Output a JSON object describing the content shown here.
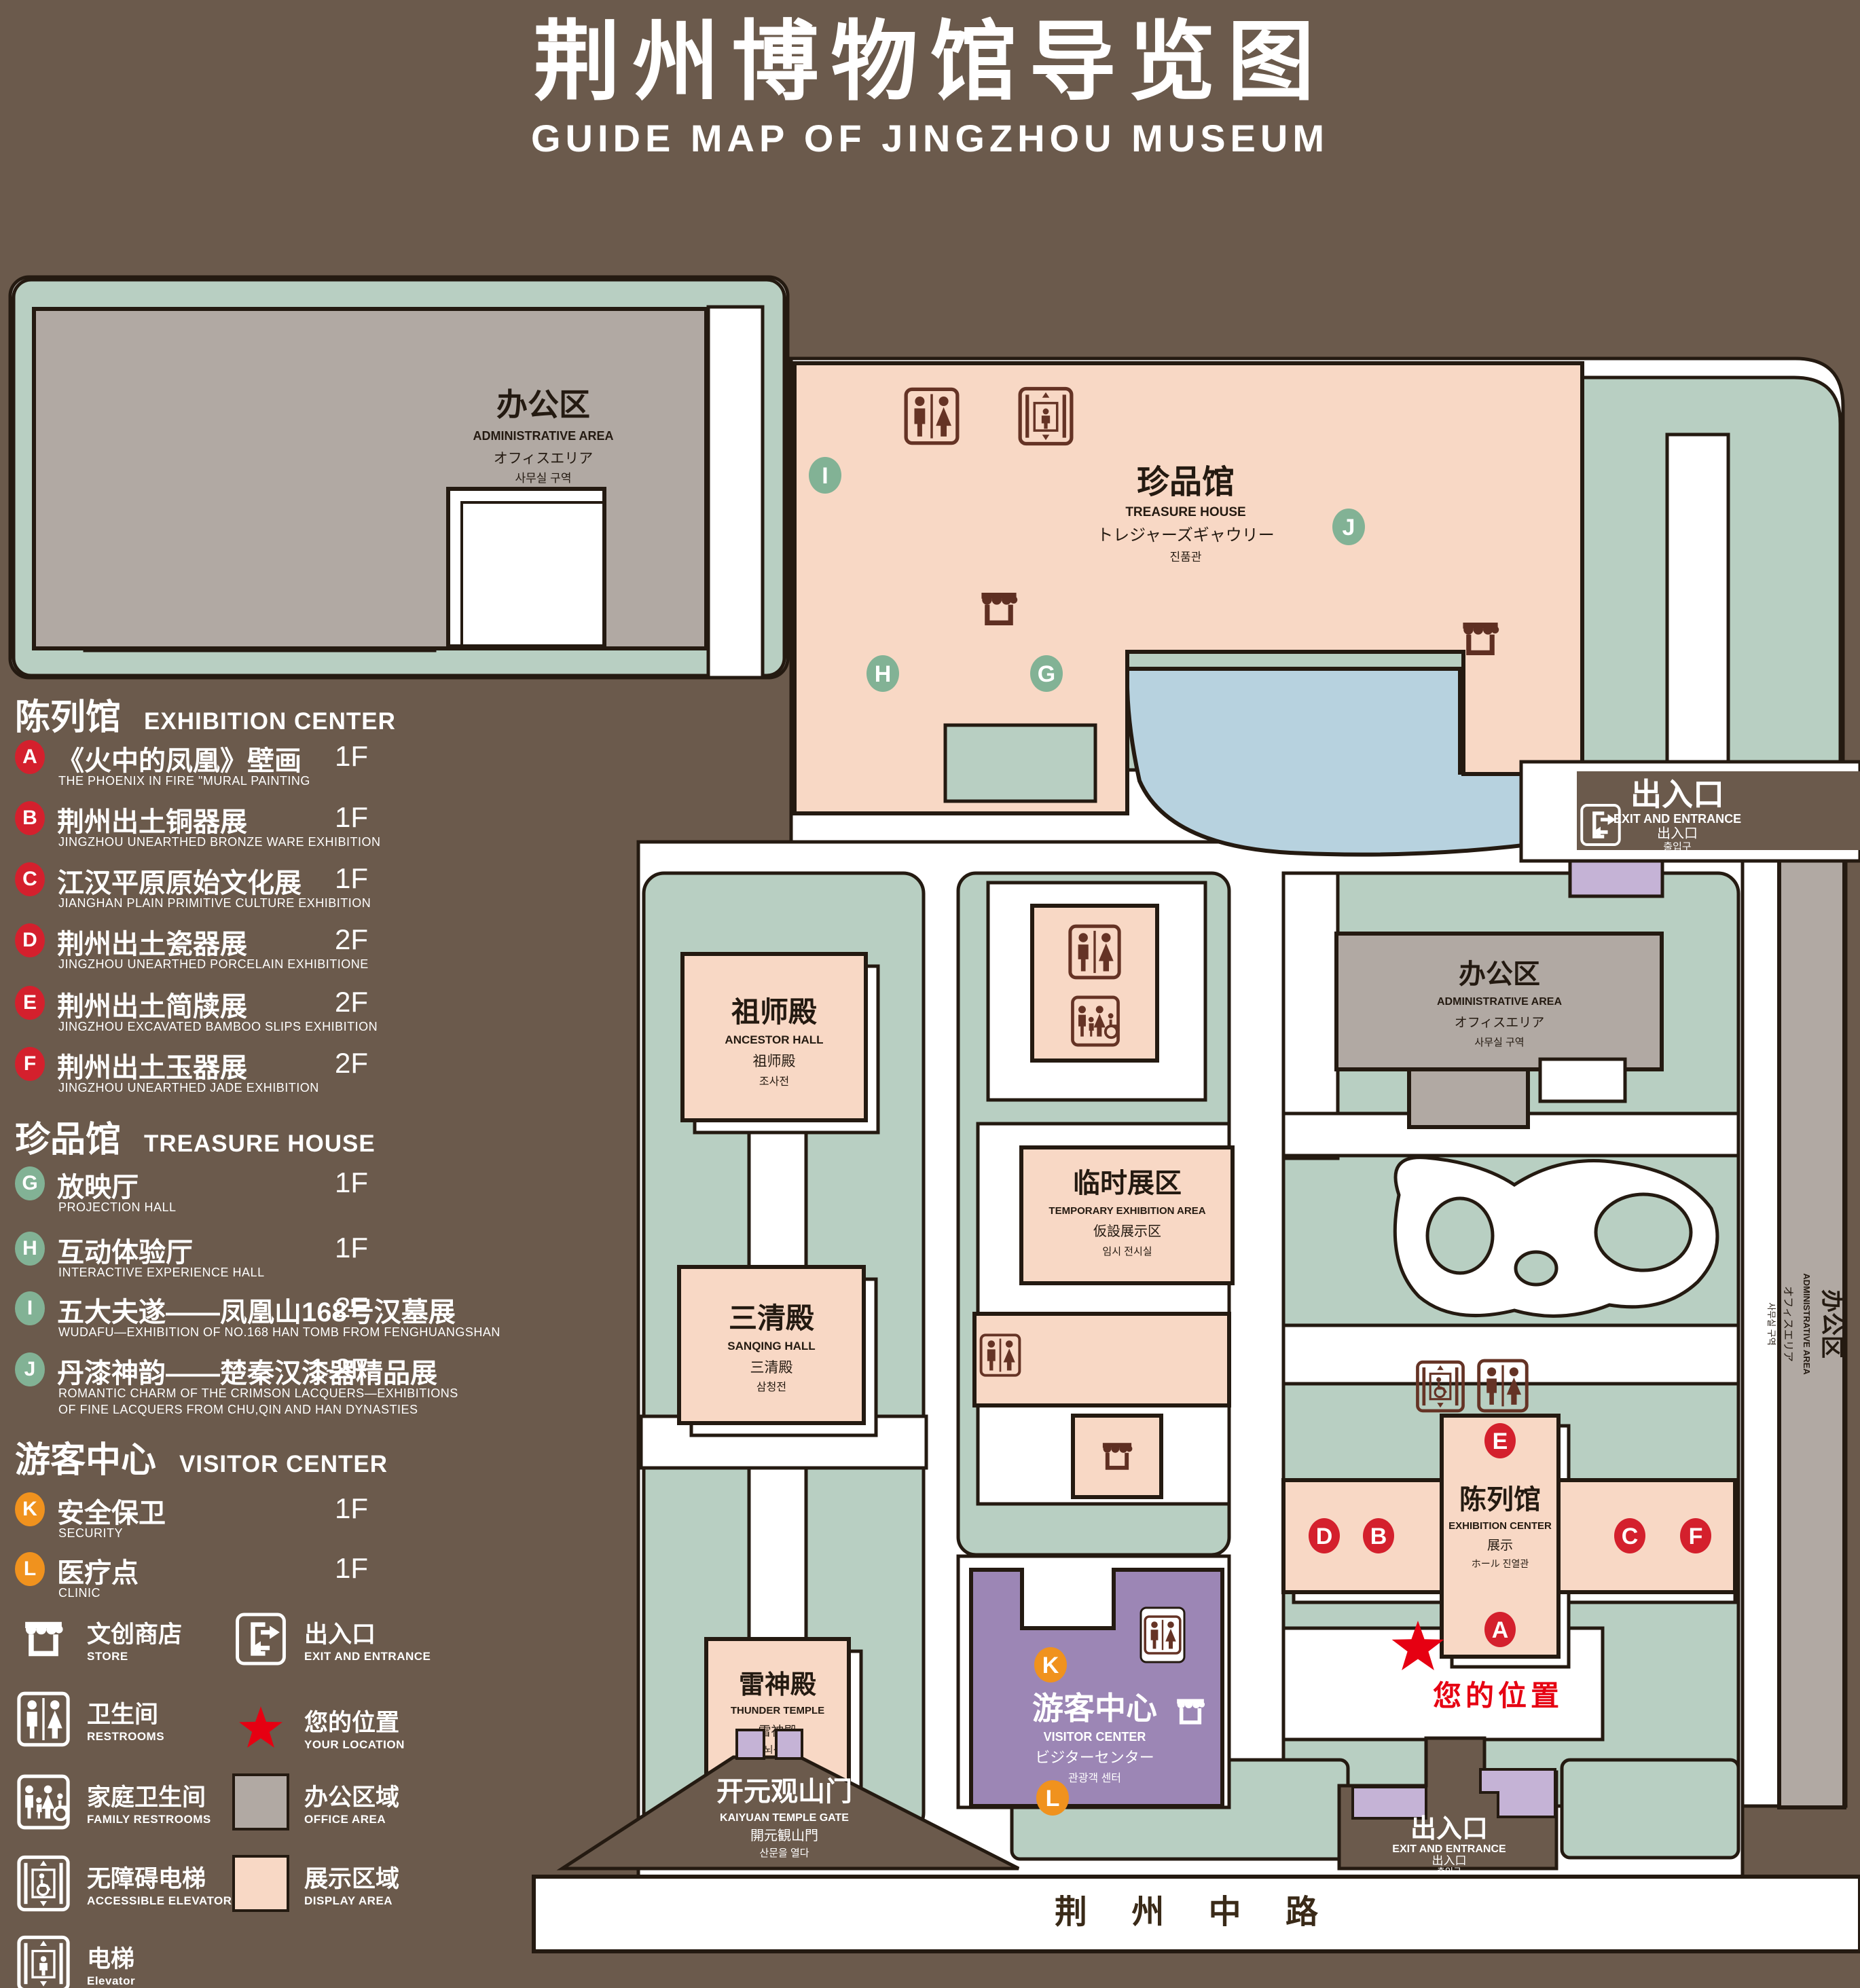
{
  "title": {
    "zh": "荆州博物馆导览图",
    "en": "GUIDE MAP OF JINGZHOU MUSEUM"
  },
  "colors": {
    "background": "#6b5a4c",
    "path_white": "#ffffff",
    "lawn_green": "#b8cfc2",
    "display_pink": "#f8d8c5",
    "office_gray": "#b1a9a3",
    "lake_blue": "#b7d2df",
    "visitor_purple": "#9c86b5",
    "small_building_lavender": "#c5b3d6",
    "badge_red": "#d4202d",
    "badge_green": "#82b295",
    "badge_orange": "#f0921e",
    "icon_brown": "#5f2f22",
    "location_red": "#e60012",
    "outline_dark": "#241a11"
  },
  "legend": {
    "sections": [
      {
        "zh": "陈列馆",
        "en": "EXHIBITION CENTER",
        "items": [
          {
            "letter": "A",
            "zh": "《火中的凤凰》壁画",
            "en": "THE PHOENIX IN FIRE \"MURAL PAINTING",
            "floor": "1F"
          },
          {
            "letter": "B",
            "zh": "荆州出土铜器展",
            "en": "JINGZHOU UNEARTHED BRONZE WARE EXHIBITION",
            "floor": "1F"
          },
          {
            "letter": "C",
            "zh": "江汉平原原始文化展",
            "en": "JIANGHAN PLAIN PRIMITIVE CULTURE EXHIBITION",
            "floor": "1F"
          },
          {
            "letter": "D",
            "zh": "荆州出土瓷器展",
            "en": "JINGZHOU UNEARTHED PORCELAIN EXHIBITIONE",
            "floor": "2F"
          },
          {
            "letter": "E",
            "zh": "荆州出土简牍展",
            "en": "JINGZHOU EXCAVATED BAMBOO SLIPS EXHIBITION",
            "floor": "2F"
          },
          {
            "letter": "F",
            "zh": "荆州出土玉器展",
            "en": "JINGZHOU UNEARTHED JADE EXHIBITION",
            "floor": "2F"
          }
        ]
      },
      {
        "zh": "珍品馆",
        "en": "TREASURE HOUSE",
        "items": [
          {
            "letter": "G",
            "zh": "放映厅",
            "en": "PROJECTION HALL",
            "floor": "1F"
          },
          {
            "letter": "H",
            "zh": "互动体验厅",
            "en": "INTERACTIVE EXPERIENCE HALL",
            "floor": "1F"
          },
          {
            "letter": "I",
            "zh": "五大夫遂——凤凰山168号汉墓展",
            "en": "WUDAFU—EXHIBITION OF NO.168 HAN TOMB FROM FENGHUANGSHAN",
            "floor": "2F"
          },
          {
            "letter": "J",
            "zh": "丹漆神韵——楚秦汉漆器精品展",
            "en": "ROMANTIC CHARM OF THE CRIMSON LACQUERS—EXHIBITIONS",
            "en2": "OF FINE LACQUERS FROM CHU,QIN AND HAN DYNASTIES",
            "floor": "1-2F"
          }
        ]
      },
      {
        "zh": "游客中心",
        "en": "VISITOR CENTER",
        "items": [
          {
            "letter": "K",
            "zh": "安全保卫",
            "en": "SECURITY",
            "floor": "1F"
          },
          {
            "letter": "L",
            "zh": "医疗点",
            "en": "CLINIC",
            "floor": "1F"
          }
        ]
      }
    ],
    "symbols": [
      {
        "icon": "store-icon",
        "zh": "文创商店",
        "en": "STORE"
      },
      {
        "icon": "restrooms-icon",
        "zh": "卫生间",
        "en": "RESTROOMS"
      },
      {
        "icon": "family-restrooms-icon",
        "zh": "家庭卫生间",
        "en": "FAMILY RESTROOMS"
      },
      {
        "icon": "accessible-elevator-icon",
        "zh": "无障碍电梯",
        "en": "ACCESSIBLE ELEVATOR"
      },
      {
        "icon": "elevator-icon",
        "zh": "电梯",
        "en": "Elevator"
      },
      {
        "icon": "exit-icon",
        "zh": "出入口",
        "en": "EXIT AND ENTRANCE"
      },
      {
        "icon": "your-location-icon",
        "zh": "您的位置",
        "en": "YOUR LOCATION"
      },
      {
        "icon": "office-area-swatch",
        "zh": "办公区域",
        "en": "OFFICE AREA"
      },
      {
        "icon": "display-area-swatch",
        "zh": "展示区域",
        "en": "DISPLAY AREA"
      }
    ]
  },
  "map": {
    "admin_nw": {
      "zh": "办公区",
      "en": "ADMINISTRATIVE AREA",
      "jp": "オフィスエリア",
      "kr": "사무실 구역"
    },
    "admin_center": {
      "zh": "办公区",
      "en": "ADMINISTRATIVE AREA",
      "jp": "オフィスエリア",
      "kr": "사무실 구역"
    },
    "admin_east": {
      "zh": "办公区",
      "en": "ADMINISTRATIVE AREA",
      "jp": "オフィスエリア",
      "kr": "사무실 구역"
    },
    "treasure_house": {
      "zh": "珍品馆",
      "en": "TREASURE HOUSE",
      "jp": "トレジャーズギャウリー",
      "kr": "진품관"
    },
    "ancestor_hall": {
      "zh": "祖师殿",
      "en": "ANCESTOR HALL",
      "jp": "祖师殿",
      "kr": "조사전"
    },
    "sanqing_hall": {
      "zh": "三清殿",
      "en": "SANQING HALL",
      "jp": "三清殿",
      "kr": "삼청전"
    },
    "thunder_temple": {
      "zh": "雷神殿",
      "en": "THUNDER TEMPLE",
      "jp": "雷神殿",
      "kr": "뇌신전"
    },
    "temporary_exhibition": {
      "zh": "临时展区",
      "en": "TEMPORARY EXHIBITION AREA",
      "jp": "仮設展示区",
      "kr": "임시 전시실"
    },
    "visitor_center": {
      "zh": "游客中心",
      "en": "VISITOR CENTER",
      "jp": "ビジターセンター",
      "kr": "관광객 센터"
    },
    "exhibition_center": {
      "zh": "陈列馆",
      "en": "EXHIBITION CENTER",
      "jp": "展示",
      "jp_kr": "ホール 진열관"
    },
    "exit_northeast": {
      "zh": "出入口",
      "en": "EXIT AND ENTRANCE",
      "jp": "出入口",
      "kr": "출입구"
    },
    "exit_south": {
      "zh": "出入口",
      "en": "EXIT AND ENTRANCE",
      "jp": "出入口",
      "kr": "출입구"
    },
    "gate": {
      "zh": "开元观山门",
      "en": "KAIYUAN TEMPLE GATE",
      "jp": "開元観山門",
      "kr": "산문을 열다"
    },
    "road": {
      "zh": "荆 州 中 路"
    },
    "your_location": {
      "zh": "您的位置"
    },
    "markers": {
      "a": "A",
      "b": "B",
      "c": "C",
      "d": "D",
      "e": "E",
      "f": "F",
      "g": "G",
      "h": "H",
      "i": "I",
      "j": "J",
      "k": "K",
      "l": "L"
    }
  }
}
